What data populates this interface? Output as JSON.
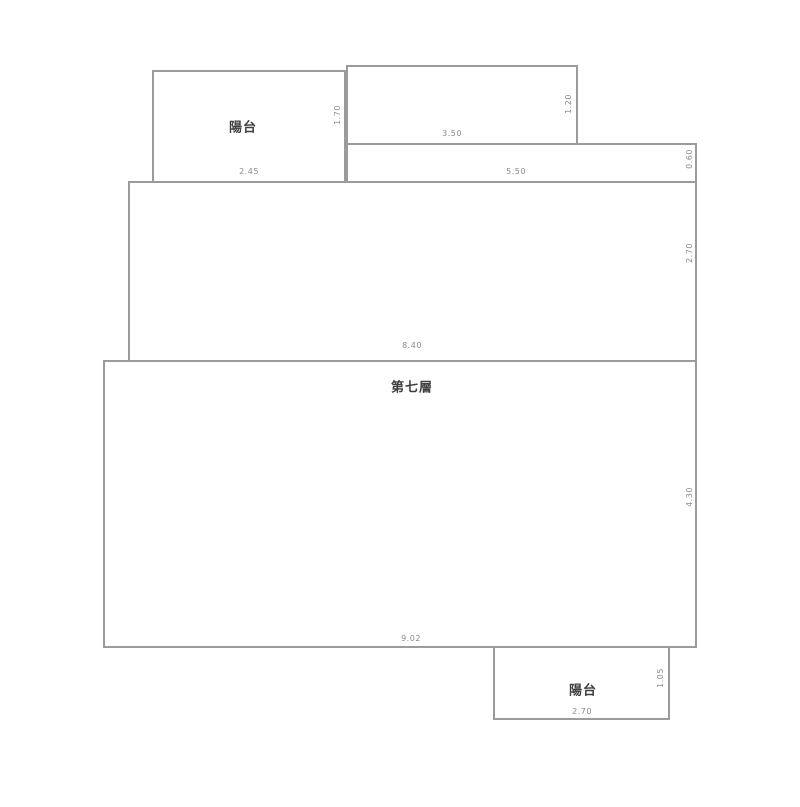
{
  "diagram": {
    "type": "floor-plan",
    "floor_label": "第七層",
    "balcony_top_label": "陽台",
    "balcony_bottom_label": "陽台",
    "dims": {
      "balcony_top_width": "2.45",
      "balcony_top_height": "1.70",
      "top_right_width": "3.50",
      "top_right_height": "1.20",
      "strip_width": "5.50",
      "strip_height": "0.60",
      "upper_body_width": "8.40",
      "upper_body_height": "2.70",
      "lower_body_width": "9.02",
      "lower_body_height": "4.30",
      "balcony_bottom_width": "2.70",
      "balcony_bottom_height": "1.05"
    },
    "colors": {
      "line": "#9b9b9b",
      "dim_text": "#8a8a8a",
      "label_text": "#3f3f3f",
      "background": "#ffffff"
    }
  }
}
